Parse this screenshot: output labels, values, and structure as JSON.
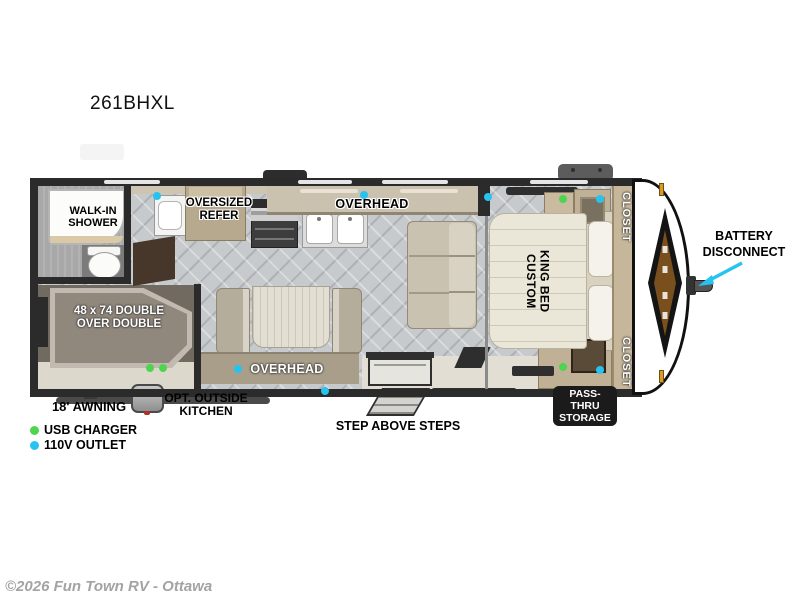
{
  "title": "261BHXL",
  "rooms": {
    "shower": "WALK-IN\nSHOWER",
    "refer": "OVERSIZED\nREFER",
    "overhead_kitchen": "OVERHEAD",
    "overhead_dinette": "OVERHEAD",
    "king_bed": "CUSTOM\nKING BED",
    "closet_top": "CLOSET",
    "closet_bottom": "CLOSET",
    "bunk": "48 x 74 DOUBLE\nOVER DOUBLE"
  },
  "exterior": {
    "battery": "BATTERY\nDISCONNECT",
    "awning": "18' AWNING",
    "outside_kitchen": "OPT. OUTSIDE\nKITCHEN",
    "steps": "STEP ABOVE STEPS",
    "pass_thru": "PASS-THRU\nSTORAGE"
  },
  "legend": {
    "usb": "USB CHARGER",
    "outlet": "110V OUTLET"
  },
  "colors": {
    "usb_green": "#4ed44e",
    "outlet_cyan": "#27c3f0"
  },
  "footer": "©2026 Fun Town RV - Ottawa"
}
